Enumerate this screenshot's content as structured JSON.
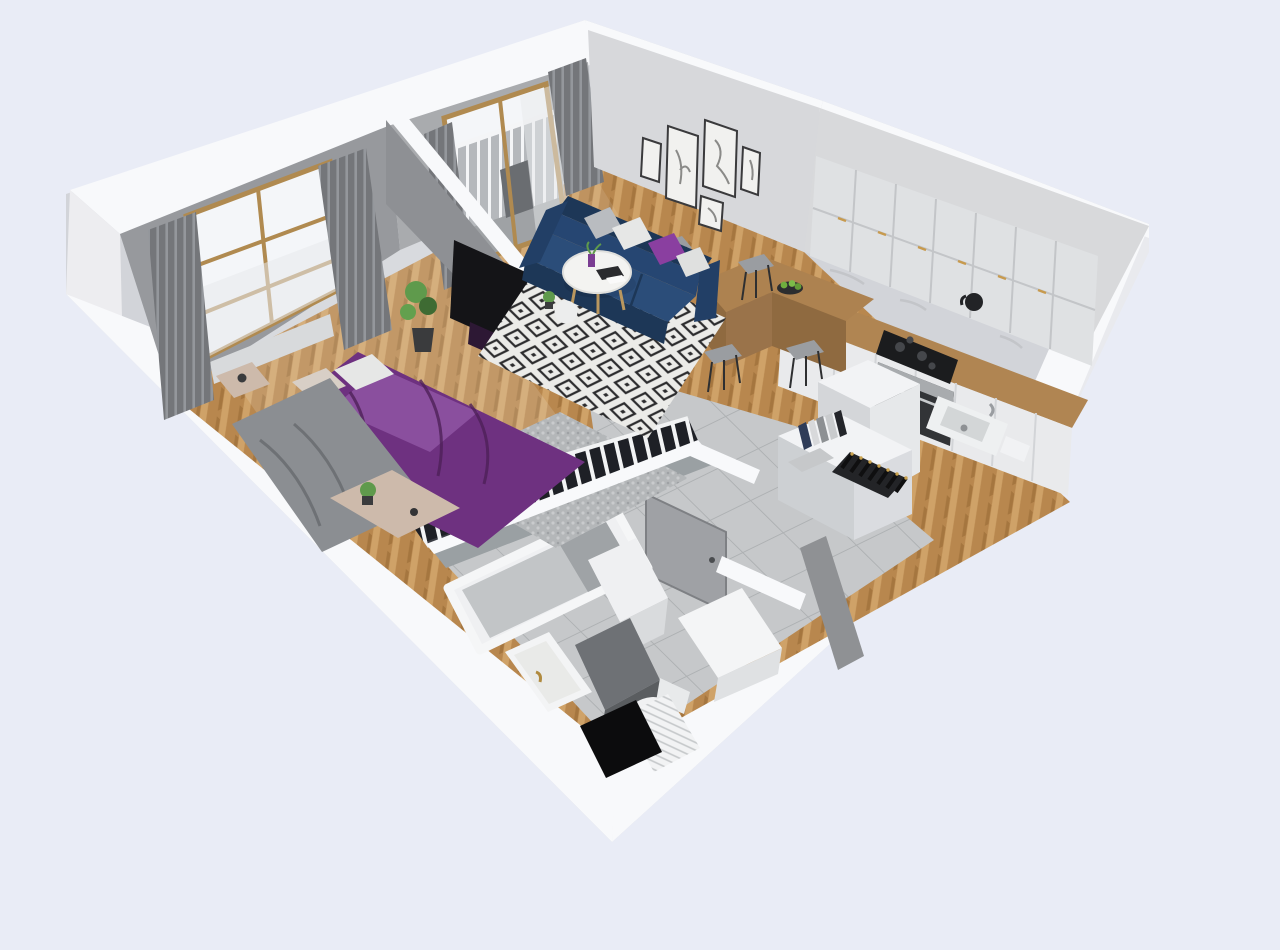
{
  "scene": {
    "title": "3D isometric apartment floor plan render",
    "view": "dollhouse cutaway, walls cut at top, viewed from above south-east",
    "rooms": [
      {
        "name": "bedroom",
        "furniture": [
          "purple-double-bed",
          "gray-throw-blanket",
          "beige-bench-nightstand",
          "open-wardrobe-clothes",
          "knit-rug",
          "wall-tv",
          "window-with-curtains",
          "potted-plant",
          "side-table"
        ]
      },
      {
        "name": "living-room",
        "furniture": [
          "navy-sofa",
          "throw-pillows",
          "round-coffee-table",
          "white-ottoman",
          "diamond-pattern-rug",
          "gallery-wall-5-frames",
          "balcony-door-with-railing",
          "sheer-curtains"
        ]
      },
      {
        "name": "kitchen",
        "furniture": [
          "white-upper-cabinets",
          "marble-backsplash",
          "wood-countertop",
          "cooktop",
          "oven",
          "kettle",
          "sink",
          "bar-peninsula",
          "4-bar-stools",
          "fridge",
          "fruit-bowl"
        ]
      },
      {
        "name": "hallway",
        "furniture": [
          "storage-cabinet",
          "book-row",
          "wine-rack-bottles",
          "open-gray-door",
          "large-gray-floor-tiles"
        ]
      },
      {
        "name": "bathroom",
        "furniture": [
          "bathtub",
          "vanity-with-gold-faucet",
          "toilet",
          "striped-shower-mat",
          "dark-washer-block",
          "white-storage-column",
          "black-doormat",
          "gray-partition-walls"
        ]
      }
    ],
    "counts": {
      "gallery_frames": 5,
      "bar_stools": 4,
      "windows": 1,
      "balcony_doors": 1,
      "wine_bottles": 7
    }
  },
  "palette": {
    "bg": "#e9ecf6",
    "wall_outer": "#d2d4d9",
    "wall_outer_light": "#e9eaee",
    "wall_cap": "#f8f9fb",
    "wall_end": "#ededf0",
    "wall_inner_gray": "#97999d",
    "wall_inner_light": "#a9abae",
    "partition_gray": "#8e9094",
    "gallery_wall": "#d7d8db",
    "shaft_dark": "#54565a",
    "wood": "#b8874e",
    "wood_light": "#cfa268",
    "wood_dark": "#a5763f",
    "tile": "#c6c8ca",
    "tile_grout": "#aeb1b3",
    "bath_wall": "#9aa0a3",
    "bed_purple": "#6e3180",
    "bed_purple_light": "#9a5fae",
    "bed_purple_dark": "#4d2058",
    "blanket_gray": "#8b8e92",
    "pillow_white": "#e6e7e6",
    "pillow_gray": "#b9bcc0",
    "pillow_purple": "#8a3fa0",
    "pillow_beige": "#d8cfc6",
    "sofa_navy": "#2b4d79",
    "sofa_navy_mid": "#264672",
    "sofa_navy_dark": "#1d3757",
    "rug_white": "#ebebe8",
    "rug_black": "#2c2c2e",
    "knit_rug": "#b4b7b9",
    "curtain_dark": "#74767a",
    "curtain_pleat": "#94979c",
    "sheer": "#e8eaec",
    "window_frame": "#b08a50",
    "glass": "#f4f6f9",
    "counter_wood": "#b08552",
    "bar_wood": "#ad8250",
    "bar_wood_dark": "#8f6a40",
    "cabinet_white": "#e9eaec",
    "cabinet_top": "#f2f3f5",
    "cabinet_face": "#dfe1e3",
    "marble": "#d8d9db",
    "appliance_black": "#1b1c1e",
    "oven_dark": "#323437",
    "steel": "#a8abae",
    "gold": "#c79a4e",
    "plant_green": "#5f9a4c",
    "plant_dark": "#3e6b33",
    "mat_black": "#0c0c0d",
    "tub_inner": "#c2c5c7",
    "tub_shadow": "#9fa3a6",
    "door_gray": "#9fa1a5",
    "tv_black": "#141417",
    "tv_glow_purple": "#2d1834",
    "washer_dark": "#6e7175",
    "stool_gray": "#9a9da1",
    "bench_beige": "#cdbaab"
  }
}
